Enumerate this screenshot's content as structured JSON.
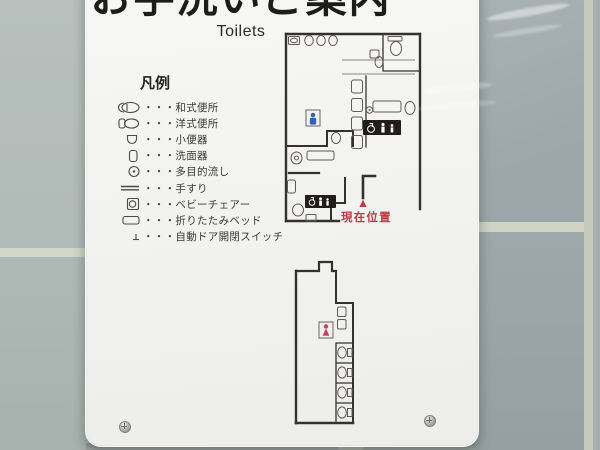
{
  "sign": {
    "title_ja": "お手洗いご案内",
    "title_en": "Toilets",
    "legend": {
      "header": "凡例",
      "items": [
        {
          "name": "squat-toilet",
          "label": "・・・和式便所"
        },
        {
          "name": "western-toilet",
          "label": "・・・洋式便所"
        },
        {
          "name": "urinal",
          "label": "・・・小便器"
        },
        {
          "name": "washbasin",
          "label": "・・・洗面器"
        },
        {
          "name": "multipurpose-sink",
          "label": "・・・多目的流し"
        },
        {
          "name": "handrail",
          "label": "・・・手すり"
        },
        {
          "name": "baby-chair",
          "label": "・・・ベビーチェアー"
        },
        {
          "name": "folding-bed",
          "label": "・・・折りたたみベッド"
        },
        {
          "name": "auto-door-switch",
          "label": "・・・自動ドア開閉スイッチ"
        }
      ]
    },
    "floor_plan": {
      "current_location_label": "現在位置",
      "colors": {
        "wall": "#35322e",
        "fixture": "#5f5b55",
        "thin_line": "#8a8781",
        "mens": "#2f63c0",
        "womens": "#d23a66",
        "current_location": "#c03a48",
        "accessible_sign_bg": "#201d1a"
      }
    }
  }
}
